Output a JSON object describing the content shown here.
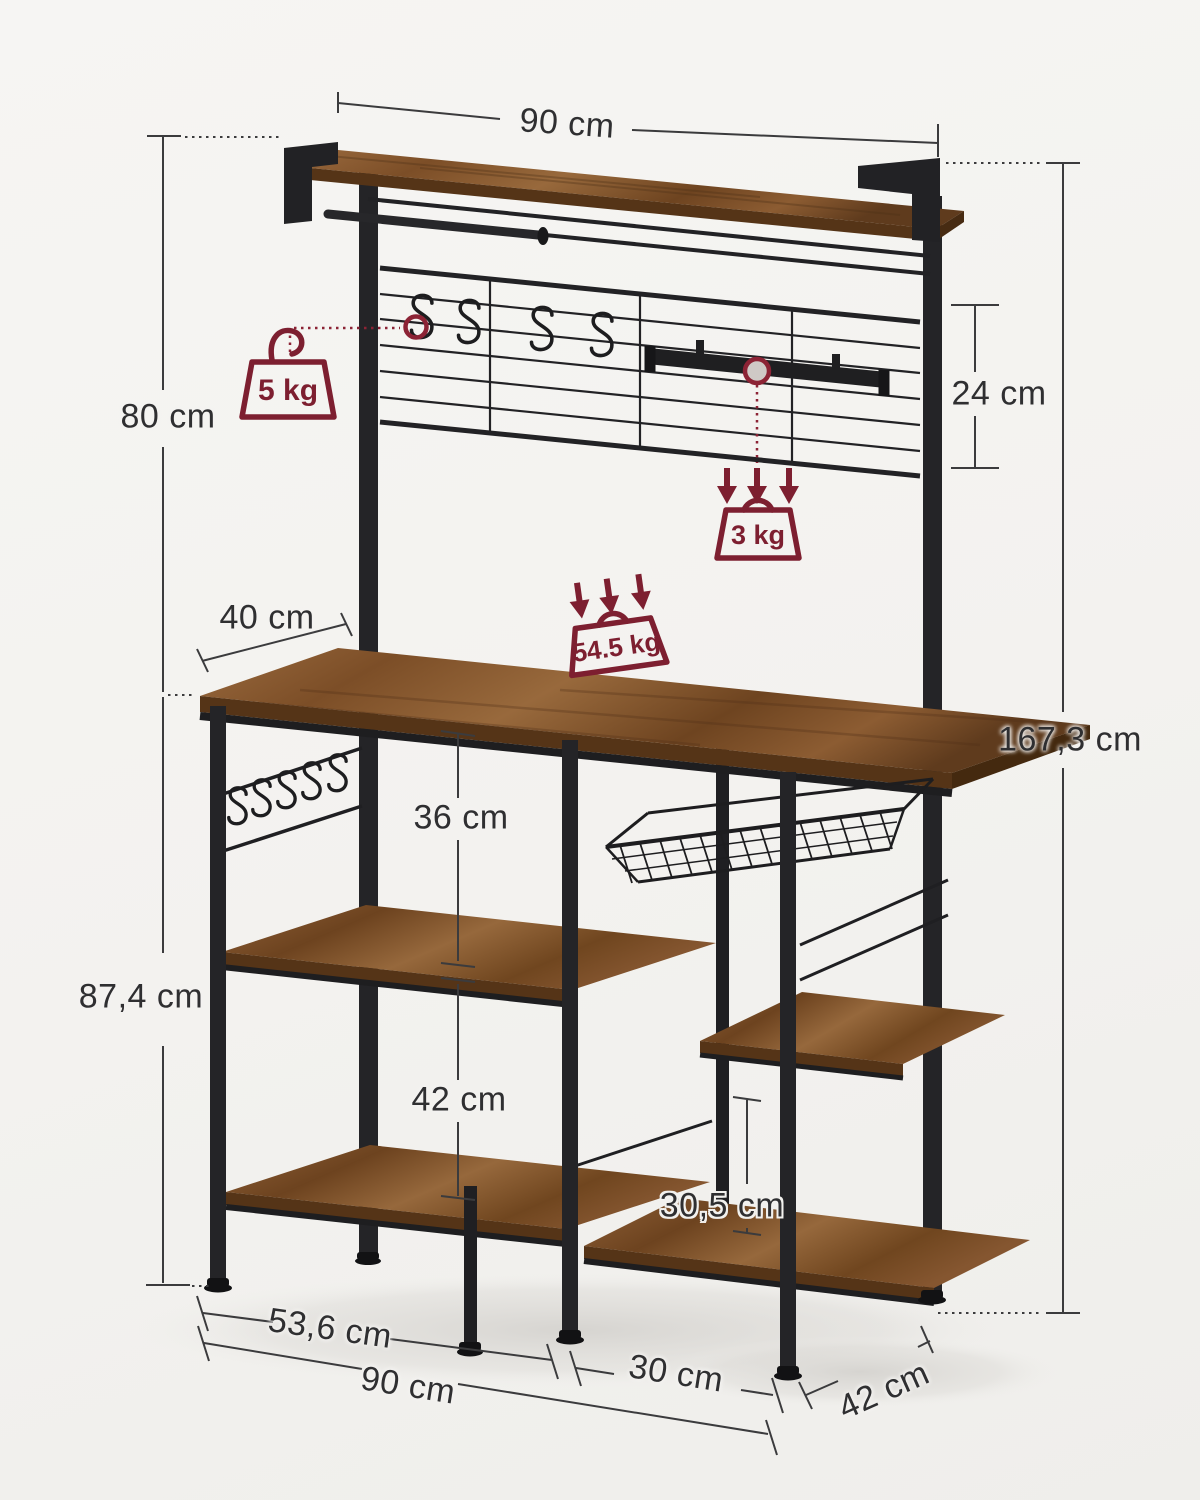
{
  "scene": {
    "background": "#f4f3f1",
    "accent_color": "#7d1f30",
    "frame_color": "#26262a",
    "wood_mid": "#8a5a33",
    "wood_edge": "#553417",
    "dim_line_color": "#3b3b3d",
    "text_color": "#2f2f31"
  },
  "labels": {
    "top_width": "90 cm",
    "hutch_height": "80 cm",
    "grid_height": "24 cm",
    "top_shelf_depth": "40 cm",
    "counter_clearance": "36 cm",
    "lower_clearance": "42 cm",
    "table_height": "87,4 cm",
    "total_height": "167,3 cm",
    "right_shelf_clearance": "30,5 cm",
    "left_section_width": "53,6 cm",
    "total_width": "90 cm",
    "right_section_width": "30 cm",
    "depth": "42 cm"
  },
  "load_capacity": {
    "hook": "5 kg",
    "rail": "3 kg",
    "countertop": "54.5 kg"
  }
}
